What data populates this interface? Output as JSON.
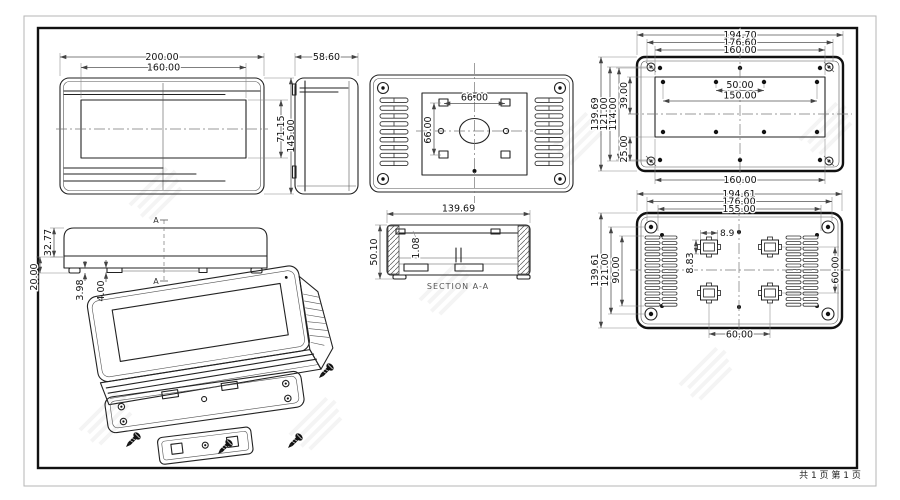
{
  "footer": {
    "page_info": "共 1 页  第 1 页"
  },
  "views": {
    "front": {
      "width": "200.00",
      "window_width": "160.00",
      "window_height": "71.15",
      "height": "145.00"
    },
    "side": {
      "depth": "58.60"
    },
    "vesa": {
      "spacing_h": "66.00",
      "spacing_v": "66.00"
    },
    "mount": {
      "top": [
        "194.70",
        "176.60",
        "160.00"
      ],
      "left": [
        "139.69",
        "121.00",
        "114.00",
        "39.00",
        "25.00"
      ],
      "hole_span": "50.00",
      "hole_span_wide": "150.00",
      "bottom": "160.00"
    },
    "topview": {
      "height_upper": "32.77",
      "height_lower": "20.00",
      "foot": "3.98",
      "tab": "4.00",
      "section_mark": "A"
    },
    "section": {
      "width": "139.69",
      "height": "50.10",
      "wall": "1.08",
      "label": "SECTION A-A"
    },
    "back": {
      "top": [
        "194.61",
        "176.00",
        "155.00"
      ],
      "left": [
        "139.61",
        "121.00",
        "90.00"
      ],
      "boss_width": "8.9",
      "boss_height": "8.83",
      "vesa_h": "60.00",
      "vesa_v": "60.00"
    }
  },
  "colors": {
    "line": "#222222",
    "dim": "#555555",
    "frame": "#111111",
    "outer_frame": "#b5b5b5"
  }
}
